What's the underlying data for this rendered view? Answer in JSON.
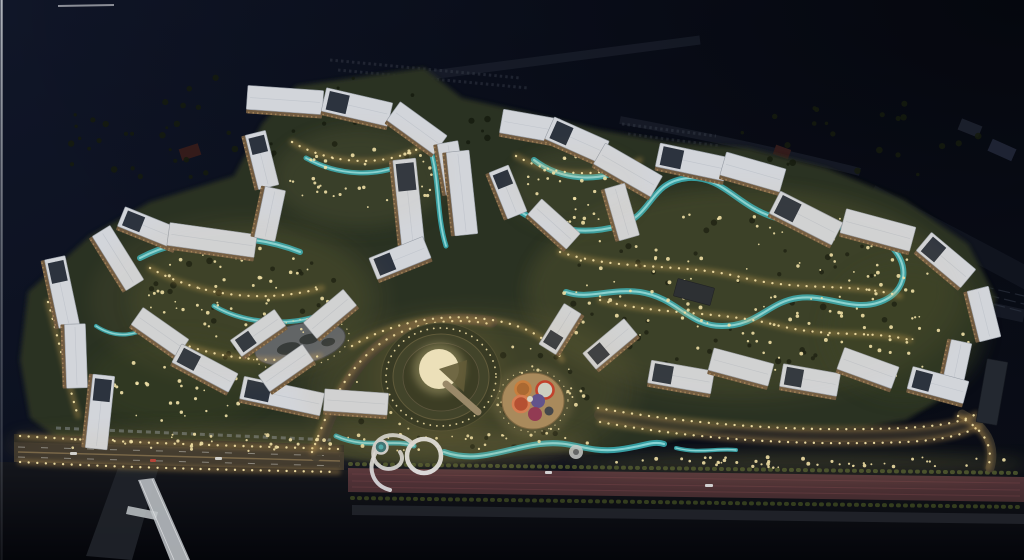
{
  "scene": {
    "description": "aerial-night-render-of-residential-masterplan",
    "canvas": {
      "w": 1024,
      "h": 560
    },
    "palette": {
      "sky": "#0c1120",
      "sky2": "#070a13",
      "ground": "#2b3120",
      "groundLight": "#3f4628",
      "roof": "#d2d5da",
      "roofEdge": "#969ca5",
      "facade": "#705a40",
      "panel": "#2c333e",
      "windows": "#caa36a",
      "water": "#37a4aa",
      "waterHi": "#9fe2e2",
      "lights": "#f2e2a8",
      "lightsGlow": "#dfae5a",
      "road": "#3a342b",
      "sidewalk": "#2c2a23",
      "redRoad": "#55343a",
      "redRoad2": "#432b2e",
      "pavement": "#23262d",
      "plaza": "#a7885c",
      "bridge": "#b4b8bd",
      "darkBuilding": "#232830",
      "treeDark": "#151b0e",
      "edgeLine": "#c2c6cc",
      "amphGlow": "#efe5c0"
    },
    "ground": {
      "d": "M28,292 L90,236 L150,202 L234,176 L262,124 L296,86 L424,68 L462,98 L524,112 L600,130 L668,142 L748,148 L826,168 L904,200 L968,244 L996,298 L986,334 L956,356 L966,372 L946,396 L906,420 L862,428 L800,430 L730,428 L662,442 L600,452 L520,452 L470,462 L420,466 L372,462 L330,456 L240,448 L150,444 L60,440 L30,418 L20,360 Z"
    },
    "buildings": [
      [
        62,
        292,
        70,
        21,
        78,
        1,
        0
      ],
      [
        76,
        356,
        64,
        21,
        88,
        0,
        0
      ],
      [
        100,
        412,
        74,
        22,
        96,
        1,
        0
      ],
      [
        118,
        258,
        64,
        21,
        58,
        0,
        0
      ],
      [
        150,
        228,
        62,
        21,
        22,
        1,
        0
      ],
      [
        212,
        240,
        88,
        23,
        8,
        0,
        0
      ],
      [
        160,
        332,
        56,
        21,
        35,
        0,
        0
      ],
      [
        205,
        368,
        64,
        21,
        28,
        1,
        0
      ],
      [
        282,
        396,
        82,
        23,
        12,
        1,
        0
      ],
      [
        356,
        402,
        64,
        22,
        4,
        0,
        0
      ],
      [
        258,
        333,
        54,
        20,
        -35,
        1,
        0
      ],
      [
        286,
        368,
        54,
        20,
        -35,
        0,
        0
      ],
      [
        285,
        100,
        76,
        24,
        4,
        0,
        0
      ],
      [
        357,
        107,
        68,
        24,
        13,
        1,
        0
      ],
      [
        417,
        128,
        58,
        23,
        36,
        0,
        0
      ],
      [
        262,
        160,
        56,
        21,
        76,
        1,
        0
      ],
      [
        270,
        214,
        52,
        21,
        102,
        0,
        0
      ],
      [
        452,
        168,
        52,
        21,
        80,
        0,
        0
      ],
      [
        409,
        205,
        92,
        23,
        84,
        1,
        0
      ],
      [
        462,
        193,
        84,
        23,
        84,
        0,
        0
      ],
      [
        530,
        126,
        58,
        24,
        10,
        0,
        0
      ],
      [
        577,
        140,
        60,
        24,
        24,
        1,
        0
      ],
      [
        628,
        170,
        66,
        24,
        30,
        0,
        0
      ],
      [
        692,
        162,
        70,
        24,
        12,
        1,
        0
      ],
      [
        753,
        172,
        62,
        24,
        16,
        0,
        0
      ],
      [
        806,
        218,
        70,
        25,
        27,
        1,
        0
      ],
      [
        878,
        230,
        72,
        25,
        15,
        0,
        0
      ],
      [
        946,
        260,
        58,
        24,
        40,
        1,
        0
      ],
      [
        984,
        314,
        52,
        22,
        76,
        0,
        0
      ],
      [
        956,
        368,
        54,
        21,
        102,
        0,
        0
      ],
      [
        508,
        192,
        50,
        21,
        68,
        1,
        0
      ],
      [
        554,
        224,
        52,
        21,
        42,
        0,
        0
      ],
      [
        622,
        212,
        54,
        21,
        74,
        0,
        0
      ],
      [
        694,
        292,
        38,
        18,
        15,
        0,
        1
      ],
      [
        400,
        258,
        58,
        23,
        -22,
        1,
        0
      ],
      [
        330,
        314,
        52,
        21,
        -40,
        0,
        0
      ],
      [
        560,
        329,
        48,
        20,
        -58,
        1,
        0
      ],
      [
        610,
        344,
        54,
        21,
        -40,
        1,
        0
      ],
      [
        681,
        377,
        64,
        23,
        10,
        1,
        0
      ],
      [
        741,
        367,
        62,
        23,
        15,
        0,
        0
      ],
      [
        810,
        380,
        58,
        23,
        10,
        1,
        0
      ],
      [
        868,
        368,
        58,
        23,
        20,
        0,
        0
      ],
      [
        938,
        385,
        58,
        23,
        15,
        1,
        0
      ],
      [
        992,
        392,
        64,
        21,
        100,
        0,
        1
      ]
    ],
    "rivers": [
      {
        "d": "M140,258 C186,234 250,232 300,252",
        "w": 6
      },
      {
        "d": "M214,306 C248,326 300,328 336,308",
        "w": 5
      },
      {
        "d": "M306,158 C338,176 378,178 408,162",
        "w": 5
      },
      {
        "d": "M430,148 C440,180 436,214 446,246",
        "w": 5
      },
      {
        "d": "M534,160 C560,180 600,184 628,166",
        "w": 6
      },
      {
        "d": "M500,196 C532,226 576,238 618,226 C654,216 648,182 688,178 C724,176 736,206 776,218 C818,232 856,218 886,242 C912,262 908,292 880,302 C852,312 828,294 798,298 C768,302 758,326 722,326 C688,326 678,298 640,292 C610,288 588,300 566,292",
        "w": 6
      },
      {
        "d": "M336,436 C366,450 394,438 414,446",
        "w": 5
      },
      {
        "d": "M444,452 C478,464 506,448 540,444 C572,440 584,452 614,450 C640,448 652,440 664,444",
        "w": 6
      },
      {
        "d": "M676,448 C700,454 716,448 736,450",
        "w": 4
      },
      {
        "d": "M96,326 C114,338 132,336 148,328",
        "w": 4
      }
    ],
    "roadSurfaces": [
      {
        "name": "branch-road-north",
        "d": "M316,456 C330,418 342,378 376,348 C406,322 450,314 492,322",
        "w": 11,
        "c": "#3b362c",
        "o": 0.9
      },
      {
        "name": "promenade-east",
        "d": "M600,415 C700,433 806,439 906,435 C944,433 964,428 978,420",
        "w": 12,
        "c": "#4a4131",
        "o": 0.55
      },
      {
        "name": "right-loop",
        "d": "M962,414 C988,428 996,446 990,468",
        "w": 9,
        "c": "#3a352c",
        "o": 0.85
      }
    ],
    "lightPaths": [
      {
        "d": "M20,436 C130,443 240,446 338,449"
      },
      {
        "d": "M20,462 C130,468 240,470 338,472"
      },
      {
        "d": "M312,452 C326,416 340,378 372,350 C402,324 448,316 490,324"
      },
      {
        "d": "M352,346 C392,322 442,312 492,320 C530,326 552,342 562,360"
      },
      {
        "d": "M598,408 C700,426 806,432 904,428 C942,426 962,422 976,414"
      },
      {
        "d": "M600,422 C700,440 806,446 906,442 C944,440 966,434 980,426"
      },
      {
        "d": "M958,416 C986,430 994,448 988,468"
      },
      {
        "d": "M150,268 C200,296 262,304 322,288"
      },
      {
        "d": "M48,302 C60,344 68,384 78,416"
      },
      {
        "d": "M292,142 C330,164 380,168 420,148"
      },
      {
        "d": "M516,156 C552,176 600,180 640,160"
      },
      {
        "d": "M560,252 C620,272 684,262 744,278 C804,292 852,282 900,296"
      },
      {
        "d": "M600,300 C660,316 720,310 780,326 C830,338 870,330 910,340"
      },
      {
        "d": "M150,330 C200,356 260,366 320,356"
      }
    ],
    "sprinkles": {
      "warm": [
        [
          235,
          298,
          95,
          52,
          55
        ],
        [
          360,
          180,
          75,
          42,
          40
        ],
        [
          575,
          190,
          55,
          35,
          32
        ],
        [
          740,
          290,
          190,
          85,
          120
        ],
        [
          470,
          395,
          120,
          55,
          60
        ],
        [
          300,
          442,
          290,
          10,
          55
        ],
        [
          800,
          462,
          225,
          6,
          45
        ],
        [
          180,
          390,
          80,
          35,
          30
        ],
        [
          905,
          330,
          70,
          60,
          35
        ]
      ],
      "dark": [
        [
          300,
          120,
          250,
          45,
          36
        ],
        [
          740,
          300,
          180,
          80,
          45
        ],
        [
          250,
          300,
          110,
          60,
          30
        ],
        [
          480,
          400,
          140,
          55,
          32
        ],
        [
          500,
          532,
          360,
          18,
          26
        ],
        [
          860,
          140,
          120,
          40,
          22
        ],
        [
          170,
          150,
          130,
          28,
          24
        ]
      ],
      "seed": 42
    },
    "amphitheater": {
      "cx": 441,
      "cy": 377,
      "stem": "M446,384 L478,412"
    },
    "plaza": {
      "cx": 533,
      "cy": 401,
      "rx": 31,
      "ry": 28,
      "circles": [
        [
          12,
          -11,
          8.5,
          "ring",
          "#c23a28",
          "#cdd2c8"
        ],
        [
          -10,
          -12,
          7.5,
          "ring",
          "#c87b3a",
          "#a8642e"
        ],
        [
          5,
          0,
          7,
          "fill",
          "#5a4e8e",
          ""
        ],
        [
          -12,
          3,
          8,
          "ring",
          "#d87a50",
          "#b44a2e"
        ],
        [
          2,
          13,
          7,
          "fill",
          "#8e3352",
          ""
        ],
        [
          16,
          10,
          4.5,
          "fill",
          "#3a3f48",
          ""
        ],
        [
          -3,
          -2,
          3,
          "fill",
          "#d8d8cc",
          ""
        ]
      ]
    },
    "ringSculpture": {
      "loop": {
        "cx": 424,
        "cy": 456,
        "r": 17
      },
      "tails": [
        "M412,443 C398,430 378,434 374,448 C370,462 382,472 394,468 C402,465 404,458 400,452",
        "M376,452 C366,470 374,486 390,490"
      ],
      "miniRoundabout": {
        "cx": 381,
        "cy": 447,
        "r": 6.5
      },
      "patternCircle": {
        "cx": 576,
        "cy": 452,
        "r": 7
      }
    },
    "pond": {
      "cx": 300,
      "cy": 344,
      "rx": 46,
      "ry": 20,
      "rot": -12
    },
    "roads": {
      "southDark": "M0,462 L340,470 L560,478 L1024,486 L1024,560 L0,560 Z",
      "sidewalkN": "M14,434 L344,445 L344,452 L14,442 Z",
      "boulevard": "M14,442 L344,452 L344,470 L14,462 Z",
      "median": "M18,452 L340,461",
      "lane1": "M18,447 L340,456",
      "lane2": "M18,457 L340,466",
      "redRoad": "M348,468 L1024,477 L1024,502 L348,492 Z",
      "streaks": [
        "M352,474 L1020,483",
        "M352,481 L1020,490",
        "M352,487 L1020,496"
      ],
      "hedgeN": "M350,464 L1020,473",
      "hedgeS": "M352,498 L1020,507",
      "pavement": "M352,505 L1024,514 L1024,524 L352,515 Z",
      "parkedCars": "M56,428 L332,440",
      "branchRamp": "M118,468 L158,470 L132,560 L86,556 Z"
    },
    "bridge": {
      "deck": "M138,480 L154,478 L190,560 L170,560 Z",
      "rail1": "M140,481 L174,560",
      "rail2": "M152,479 L188,560",
      "landing": "M128,506 L158,512 L156,520 L126,514 Z"
    },
    "cars": [
      [
        70,
        452,
        7,
        3,
        "#dfe2e4"
      ],
      [
        215,
        457,
        7,
        3,
        "#dfe2e4"
      ],
      [
        150,
        459,
        6,
        3,
        "#c04038"
      ],
      [
        705,
        484,
        8,
        3,
        "#dfe2e4"
      ],
      [
        545,
        471,
        7,
        3,
        "#dfe2e4"
      ]
    ],
    "background": {
      "roads": [
        {
          "d": "M300,92 L700,40",
          "w": 9,
          "o": 0.5
        },
        {
          "d": "M430,178 C600,220 800,268 1024,316",
          "w": 13,
          "o": 0.5
        },
        {
          "d": "M620,120 C700,135 780,152 860,172",
          "w": 8,
          "o": 0.5
        },
        {
          "d": "M870,195 C930,228 985,255 1030,280",
          "w": 22,
          "o": 0.35
        }
      ],
      "rails": [
        {
          "d": "M470,160 C650,205 850,255 1024,296"
        },
        {
          "d": "M476,168 C656,213 856,263 1024,304"
        },
        {
          "d": "M482,176 C662,221 862,271 1024,312"
        }
      ],
      "parkingRows": [
        "M622,124 L716,136",
        "M628,134 L720,146",
        "M700,156 L800,170",
        "M706,166 L806,180",
        "M330,60 L520,78",
        "M338,70 L528,88"
      ],
      "sheds": [
        [
          190,
          152,
          20,
          12,
          -18,
          "#3c1d1a"
        ],
        [
          782,
          152,
          16,
          10,
          20,
          "#3a1f1c"
        ],
        [
          970,
          128,
          22,
          12,
          22,
          "#1f2430"
        ],
        [
          1002,
          150,
          26,
          13,
          24,
          "#23283a"
        ]
      ],
      "topSliver": "M58,6 L114,5"
    },
    "ambientGlows": [
      [
        240,
        300,
        150,
        85,
        0.06
      ],
      [
        470,
        390,
        170,
        85,
        0.07
      ],
      [
        745,
        295,
        225,
        110,
        0.06
      ],
      [
        300,
        448,
        300,
        22,
        0.08
      ],
      [
        800,
        468,
        230,
        16,
        0.07
      ],
      [
        360,
        175,
        90,
        50,
        0.05
      ],
      [
        575,
        185,
        70,
        40,
        0.05
      ]
    ],
    "groundMottle": [
      [
        250,
        300,
        120,
        70,
        "#3f4628",
        0.5
      ],
      [
        470,
        390,
        150,
        70,
        "#3a4126",
        0.55
      ],
      [
        740,
        290,
        210,
        100,
        "#3c4427",
        0.5
      ],
      [
        360,
        180,
        85,
        50,
        "#39402a",
        0.5
      ],
      [
        575,
        190,
        65,
        40,
        "#39402a",
        0.45
      ],
      [
        180,
        380,
        90,
        45,
        "#394024",
        0.45
      ],
      [
        300,
        440,
        290,
        14,
        "#4a4a2c",
        0.4
      ],
      [
        800,
        462,
        230,
        8,
        "#4a4f2c",
        0.45
      ],
      [
        905,
        330,
        80,
        70,
        "#353c24",
        0.5
      ]
    ]
  }
}
